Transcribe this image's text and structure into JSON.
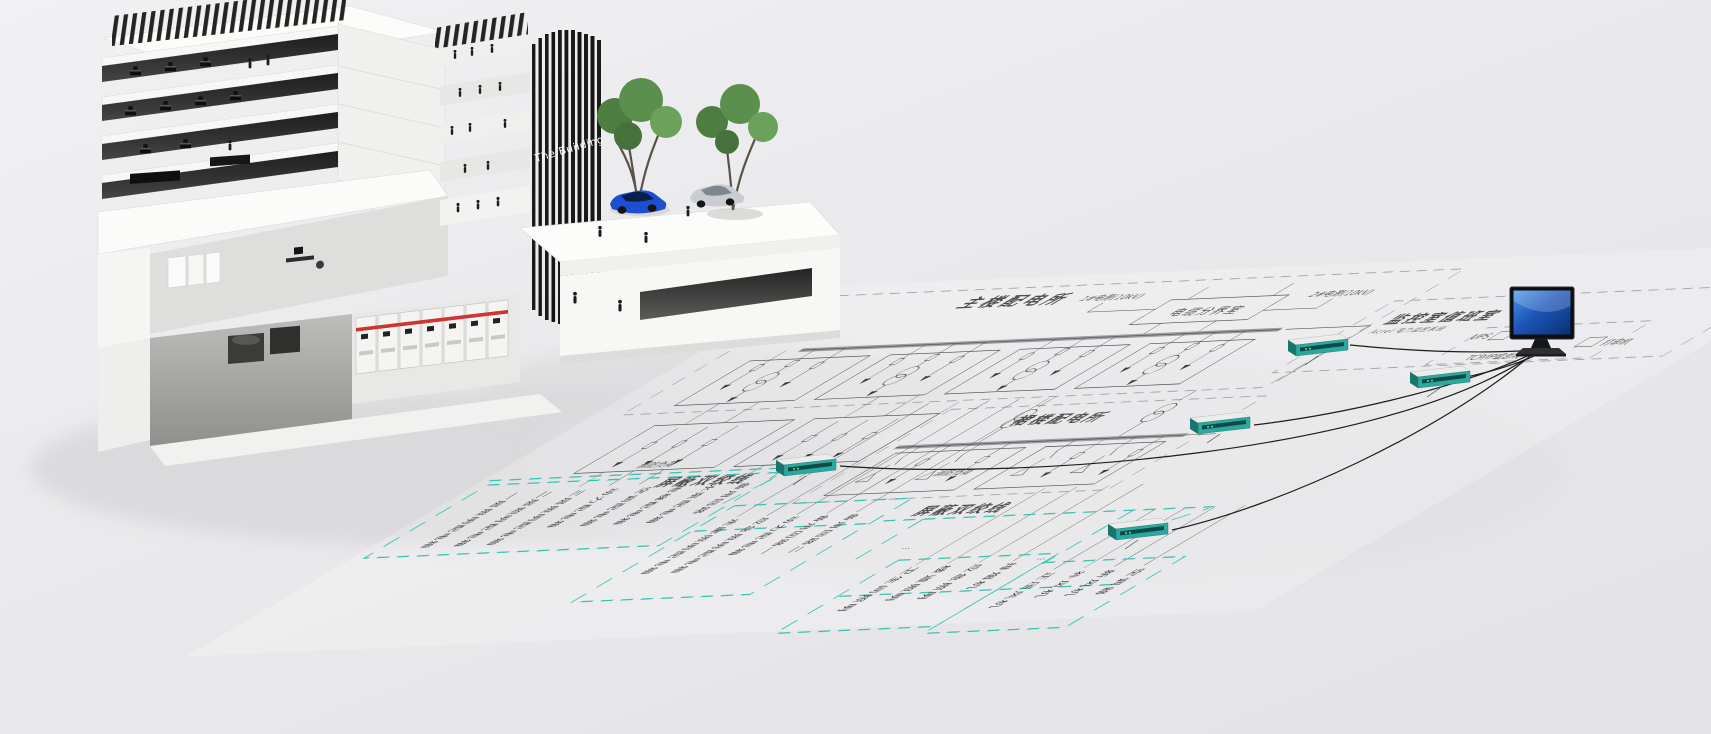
{
  "building": {
    "sign_label": "The Building"
  },
  "diagram": {
    "main_substation": {
      "label": "主楼配电所",
      "cable_room_label": "电缆分界室",
      "source_left_label": "1#电源(10kV)",
      "source_right_label": "2#电源(10kV)",
      "fire_load_label": "消防负荷"
    },
    "podium_substation": {
      "label": "裙楼配电所",
      "fire_load_label": "消防负荷"
    },
    "monitoring_room": {
      "label": "监控室值班室",
      "subtitle": "Acrel 电力监控系统",
      "ups_label": "UPS",
      "printer_label": "打印机",
      "bus_label": "TCP/IP或总线"
    },
    "shielded_twisted_pair": {
      "left_label": "屏蔽双绞线",
      "bottom_label": "屏蔽双绞线"
    },
    "field_groups": {
      "group1": {
        "loads": [
          "一层照明配电箱",
          "二层照明配电箱",
          "三层照明配电箱",
          "动力配电箱",
          "空调配电箱",
          "电梯配电箱",
          "水泵配电箱",
          "备用回路"
        ]
      },
      "group2": {
        "loads": [
          "走廊照明配电箱",
          "应急照明配电箱",
          "动力配电箱",
          "备用回路一",
          "备用回路二"
        ]
      },
      "group3": {
        "loads": [
          "卫生间照明",
          "楼道照明",
          "应急照明",
          "排烟机"
        ]
      },
      "group4": {
        "loads": [
          "正压风机",
          "补风机",
          "新风机",
          "空调器"
        ]
      },
      "ellipsis": "···"
    },
    "colors": {
      "twisted_pair_teal": "#3fc0b5",
      "device_teal": "#2ba99e",
      "line_dark": "#3c3c3c",
      "boundary_gray": "#a2a6a8",
      "switchgear_red_stripe": "#cf3434",
      "monitor_screen_blue": "#2a6fd4"
    }
  }
}
